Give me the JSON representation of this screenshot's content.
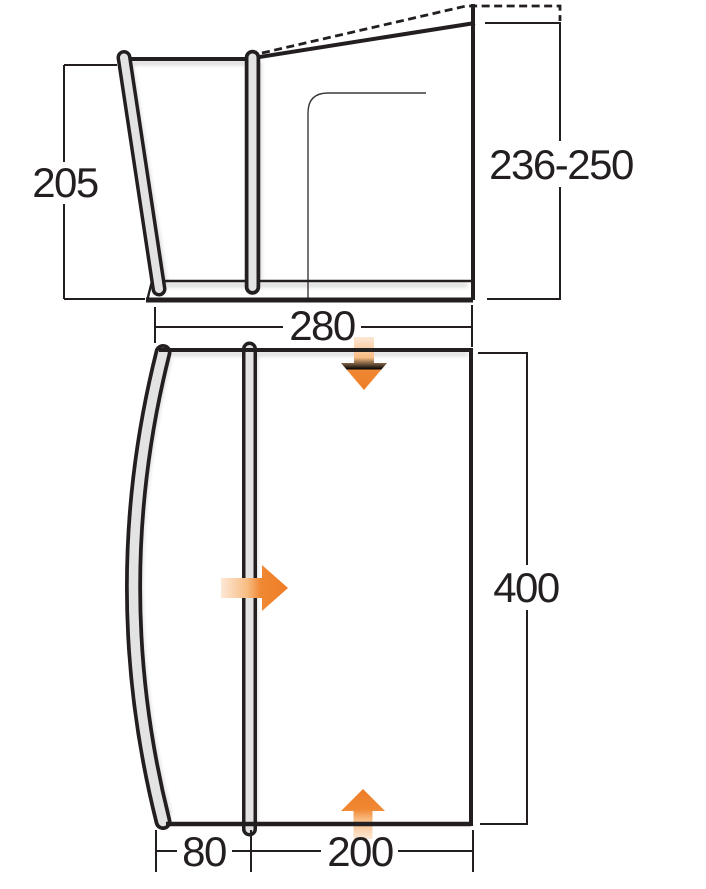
{
  "diagram": {
    "type": "tent-awning-dimension-drawing",
    "units_shown": false,
    "colors": {
      "line": "#231f20",
      "thin_line": "#3c383a",
      "arrow_orange": "#ee7d28",
      "arrow_tail": "#fdeada",
      "background": "#ffffff"
    },
    "side_elevation": {
      "labels": {
        "left_height": "205",
        "right_height": "236-250",
        "width": "280"
      }
    },
    "floor_plan": {
      "labels": {
        "length": "400",
        "front_section_width": "80",
        "main_section_width": "200"
      }
    },
    "icons": {
      "airflow": [
        "down-arrow",
        "right-arrow",
        "up-arrow"
      ]
    }
  }
}
